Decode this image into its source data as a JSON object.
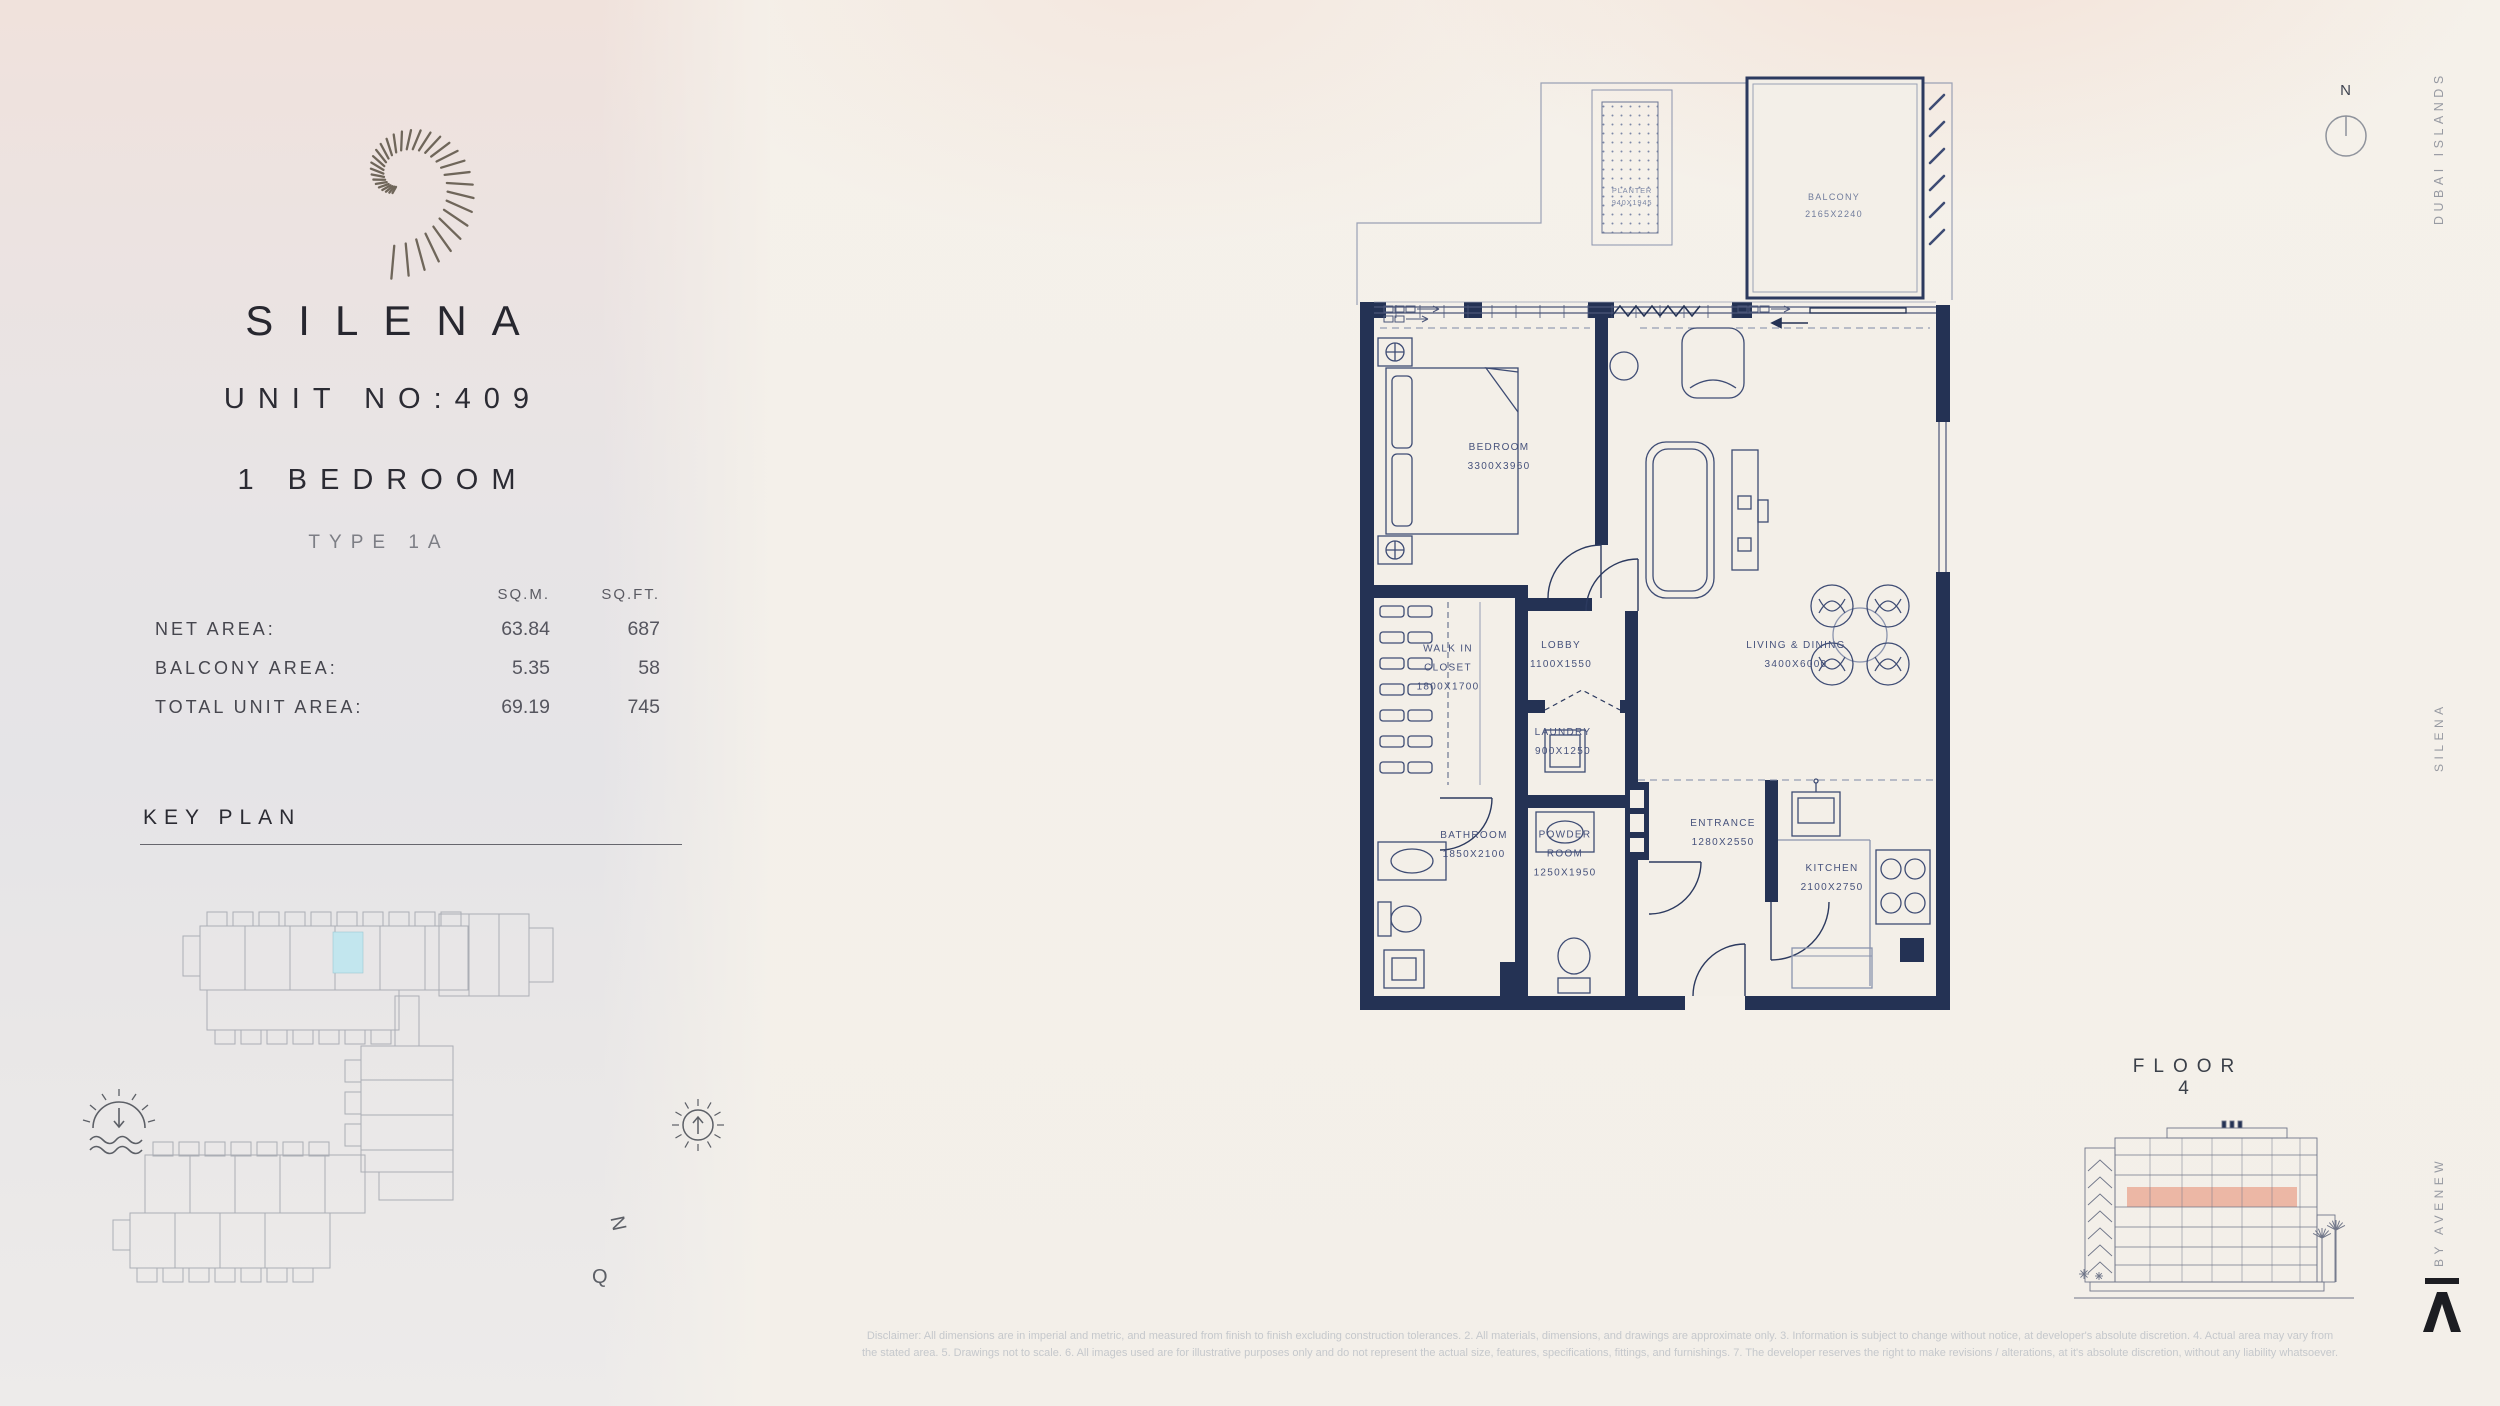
{
  "brand": {
    "logo": "spiral-shell-logo",
    "name": "SILENA",
    "unit": "UNIT NO:409",
    "bedrooms": "1 BEDROOM",
    "type": "TYPE 1A"
  },
  "areas": {
    "col1": "SQ.M.",
    "col2": "SQ.FT.",
    "rows": [
      {
        "label": "NET AREA:",
        "sqm": "63.84",
        "sqft": "687"
      },
      {
        "label": "BALCONY AREA:",
        "sqm": "5.35",
        "sqft": "58"
      },
      {
        "label": "TOTAL UNIT AREA:",
        "sqm": "69.19",
        "sqft": "745"
      }
    ]
  },
  "key_plan": {
    "title": "KEY PLAN",
    "compass_n": "N",
    "compass_q": "Q",
    "icons": [
      "sunset-icon",
      "sun-icon"
    ],
    "highlight_color": "#c2e6ee"
  },
  "plan": {
    "north": "N",
    "rooms": [
      {
        "id": "bedroom",
        "lines": [
          "BEDROOM",
          "3300X3960"
        ]
      },
      {
        "id": "walk-in-closet",
        "lines": [
          "WALK IN",
          "CLOSET",
          "1800X1700"
        ]
      },
      {
        "id": "lobby",
        "lines": [
          "LOBBY",
          "1100X1550"
        ]
      },
      {
        "id": "living-dining",
        "lines": [
          "LIVING & DINING",
          "3400X6000"
        ]
      },
      {
        "id": "laundry",
        "lines": [
          "LAUNDRY",
          "900X1250"
        ]
      },
      {
        "id": "bathroom",
        "lines": [
          "BATHROOM",
          "1850X2100"
        ]
      },
      {
        "id": "powder-room",
        "lines": [
          "POWDER",
          "ROOM",
          "1250X1950"
        ]
      },
      {
        "id": "entrance",
        "lines": [
          "ENTRANCE",
          "1280X2550"
        ]
      },
      {
        "id": "kitchen",
        "lines": [
          "KITCHEN",
          "2100X2750"
        ]
      },
      {
        "id": "planter",
        "lines": [
          "PLANTER",
          "940X1945"
        ]
      },
      {
        "id": "balcony",
        "lines": [
          "BALCONY",
          "2165X2240"
        ]
      }
    ]
  },
  "elevation": {
    "label": "FLOOR 4",
    "highlight_color": "#ecb7a5"
  },
  "side_texts": {
    "top": "DUBAI ISLANDS",
    "middle": "SILENA",
    "bottom": "BY AVENEW"
  },
  "footer_logo": "avenew-a-logo",
  "disclaimer": {
    "line1": "Disclaimer: All dimensions are in imperial and metric, and measured from finish to finish excluding construction tolerances. 2. All materials, dimensions, and drawings are approximate only. 3. Information is subject to change without notice, at developer's absolute discretion. 4. Actual area may vary from",
    "line2": "the stated area. 5. Drawings not to scale. 6. All images used are for illustrative purposes only and do not represent the actual size, features, specifications, fittings, and furnishings. 7. The developer reserves the right to make revisions / alterations, at it's absolute discretion, without any liability whatsoever."
  },
  "colors": {
    "wall": "#243254",
    "accent_salmon": "#ecb7a5",
    "highlight_cyan": "#c2e6ee",
    "text_dark": "#2b2b33"
  }
}
